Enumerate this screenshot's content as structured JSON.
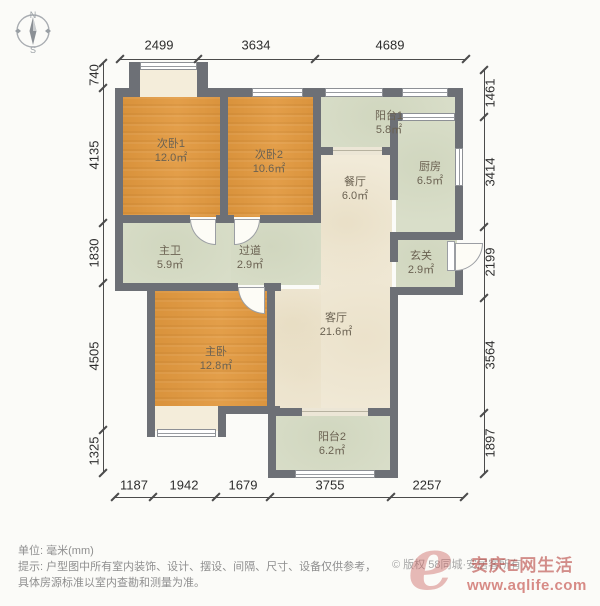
{
  "compass": {
    "north": "N",
    "south": "S"
  },
  "colors": {
    "wall": "#6d7076",
    "bedroom": "#e09943",
    "living": "#f1ead8",
    "service": "#d9dec9",
    "bay": "#f4edda",
    "watermark": "#c75e5a"
  },
  "footer": {
    "unit_label": "单位: 毫米(mm)",
    "tip_line1": "提示: 户型图中所有室内装饰、设计、摆设、间隔、尺寸、设备仅供参考，",
    "tip_line2": "具体房源标准以室内查勘和测量为准。",
    "copyright": "© 版权 58同城·安居客所有"
  },
  "watermark": {
    "logo_glyph": "e",
    "site_name": "安庆E网生活",
    "url": "www.aqlife.com"
  },
  "plan": {
    "rooms": [
      {
        "id": "bedroom-2-1",
        "label": "次卧1",
        "area": "12.0㎡",
        "fill": "bedroom",
        "rect": [
          123,
          95,
          99,
          122
        ],
        "label_at": [
          171,
          151
        ]
      },
      {
        "id": "bedroom-2-2",
        "label": "次卧2",
        "area": "10.6㎡",
        "fill": "bedroom",
        "rect": [
          226,
          95,
          89,
          122
        ],
        "label_at": [
          269,
          162
        ]
      },
      {
        "id": "balcony-1",
        "label": "阳台1",
        "area": "5.8㎡",
        "fill": "service",
        "rect": [
          320,
          93,
          137,
          58
        ],
        "label_at": [
          389,
          123
        ]
      },
      {
        "id": "kitchen",
        "label": "厨房",
        "area": "6.5㎡",
        "fill": "service",
        "rect": [
          396,
          119,
          61,
          115
        ],
        "label_at": [
          430,
          174
        ]
      },
      {
        "id": "dining",
        "label": "餐厅",
        "area": "6.0㎡",
        "fill": "living",
        "rect": [
          319,
          150,
          73,
          260
        ],
        "label_at": [
          355,
          189
        ]
      },
      {
        "id": "living",
        "label": "客厅",
        "area": "21.6㎡",
        "fill": "living",
        "rect": [
          275,
          289,
          46,
          121
        ],
        "label_at": [
          336,
          325
        ]
      },
      {
        "id": "master-bath",
        "label": "主卫",
        "area": "5.9㎡",
        "fill": "service",
        "rect": [
          123,
          221,
          108,
          64
        ],
        "label_at": [
          170,
          258
        ]
      },
      {
        "id": "hallway",
        "label": "过道",
        "area": "2.9㎡",
        "fill": "service",
        "rect": [
          231,
          221,
          90,
          64
        ],
        "label_at": [
          250,
          258
        ]
      },
      {
        "id": "master-bedroom",
        "label": "主卧",
        "area": "12.8㎡",
        "fill": "bedroom",
        "rect": [
          153,
          289,
          122,
          121
        ],
        "label_at": [
          216,
          359
        ]
      },
      {
        "id": "entry",
        "label": "玄关",
        "area": "2.9㎡",
        "fill": "service",
        "rect": [
          396,
          238,
          61,
          51
        ],
        "label_at": [
          421,
          263
        ]
      },
      {
        "id": "balcony-2",
        "label": "阳台2",
        "area": "6.2㎡",
        "fill": "service",
        "rect": [
          276,
          414,
          116,
          58
        ],
        "label_at": [
          332,
          444
        ]
      },
      {
        "id": "bay-window-top",
        "fill": "bay",
        "rect": [
          140,
          68,
          57,
          29
        ]
      },
      {
        "id": "bay-window-bottom",
        "fill": "bay",
        "rect": [
          155,
          406,
          63,
          25
        ]
      }
    ],
    "walls": [
      [
        115,
        88,
        25,
        9
      ],
      [
        197,
        88,
        266,
        9
      ],
      [
        115,
        88,
        8,
        203
      ],
      [
        455,
        88,
        8,
        152
      ],
      [
        455,
        270,
        8,
        25
      ],
      [
        220,
        95,
        8,
        125
      ],
      [
        123,
        215,
        67,
        8
      ],
      [
        216,
        215,
        18,
        8
      ],
      [
        260,
        215,
        61,
        8
      ],
      [
        313,
        88,
        8,
        135
      ],
      [
        115,
        283,
        123,
        8
      ],
      [
        264,
        283,
        17,
        8
      ],
      [
        267,
        289,
        8,
        121
      ],
      [
        147,
        289,
        8,
        148
      ],
      [
        218,
        406,
        62,
        8
      ],
      [
        268,
        406,
        8,
        72
      ],
      [
        276,
        408,
        26,
        8
      ],
      [
        368,
        408,
        24,
        8
      ],
      [
        390,
        295,
        8,
        183
      ],
      [
        268,
        470,
        27,
        8
      ],
      [
        375,
        470,
        23,
        8
      ],
      [
        321,
        147,
        12,
        8
      ],
      [
        382,
        147,
        16,
        8
      ],
      [
        390,
        113,
        8,
        87
      ],
      [
        390,
        232,
        73,
        8
      ],
      [
        390,
        240,
        8,
        22
      ],
      [
        390,
        287,
        65,
        8
      ],
      [
        398,
        113,
        6,
        8
      ],
      [
        129,
        62,
        11,
        27
      ],
      [
        197,
        62,
        11,
        27
      ],
      [
        218,
        414,
        8,
        23
      ]
    ],
    "windows": [
      [
        252,
        88,
        51,
        9,
        "h"
      ],
      [
        325,
        88,
        58,
        9,
        "h"
      ],
      [
        402,
        88,
        46,
        9,
        "h"
      ],
      [
        140,
        62,
        57,
        8,
        "h"
      ],
      [
        402,
        113,
        53,
        8,
        "h"
      ],
      [
        455,
        148,
        8,
        38,
        "v"
      ],
      [
        295,
        470,
        80,
        8,
        "h"
      ],
      [
        157,
        429,
        59,
        8,
        "h"
      ]
    ],
    "openings": [
      [
        302,
        408,
        66,
        8
      ],
      [
        333,
        147,
        49,
        8
      ]
    ],
    "doors": [
      {
        "rect": [
          190,
          219,
          26,
          26
        ],
        "corner": "bl"
      },
      {
        "rect": [
          234,
          219,
          26,
          26
        ],
        "corner": "br"
      },
      {
        "rect": [
          238,
          287,
          27,
          27
        ],
        "corner": "bl"
      },
      {
        "rect": [
          455,
          243,
          28,
          28
        ],
        "corner": "br"
      }
    ],
    "door_leaves": [
      [
        447,
        241,
        8,
        30
      ]
    ],
    "dims": [
      {
        "side": "top",
        "axis": "h",
        "line": [
          120,
          59,
          346
        ],
        "tick_cross": 59,
        "ticks": [
          120,
          198,
          315,
          466
        ],
        "label_cross": 45,
        "rot": false,
        "labels": [
          [
            "2499",
            159
          ],
          [
            "3634",
            256
          ],
          [
            "4689",
            390
          ]
        ]
      },
      {
        "side": "bottom",
        "axis": "h",
        "line": [
          115,
          497,
          349
        ],
        "tick_cross": 497,
        "ticks": [
          115,
          153,
          216,
          270,
          391,
          464
        ],
        "label_cross": 485,
        "rot": false,
        "labels": [
          [
            "1187",
            134
          ],
          [
            "1942",
            184
          ],
          [
            "1679",
            243
          ],
          [
            "3755",
            330
          ],
          [
            "2257",
            427
          ]
        ]
      },
      {
        "side": "left",
        "axis": "v",
        "line": [
          103,
          63,
          410
        ],
        "tick_cross": 103,
        "ticks": [
          63,
          88,
          223,
          283,
          430,
          473
        ],
        "label_cross": 94,
        "rot": true,
        "labels": [
          [
            "740",
            75
          ],
          [
            "4135",
            155
          ],
          [
            "1830",
            253
          ],
          [
            "4505",
            356
          ],
          [
            "1325",
            451
          ]
        ]
      },
      {
        "side": "right",
        "axis": "v",
        "line": [
          484,
          70,
          404
        ],
        "tick_cross": 484,
        "ticks": [
          70,
          117,
          227,
          298,
          413,
          474
        ],
        "label_cross": 490,
        "rot": true,
        "labels": [
          [
            "1461",
            93
          ],
          [
            "3414",
            172
          ],
          [
            "2199",
            262
          ],
          [
            "3564",
            355
          ],
          [
            "1897",
            443
          ]
        ]
      }
    ]
  }
}
